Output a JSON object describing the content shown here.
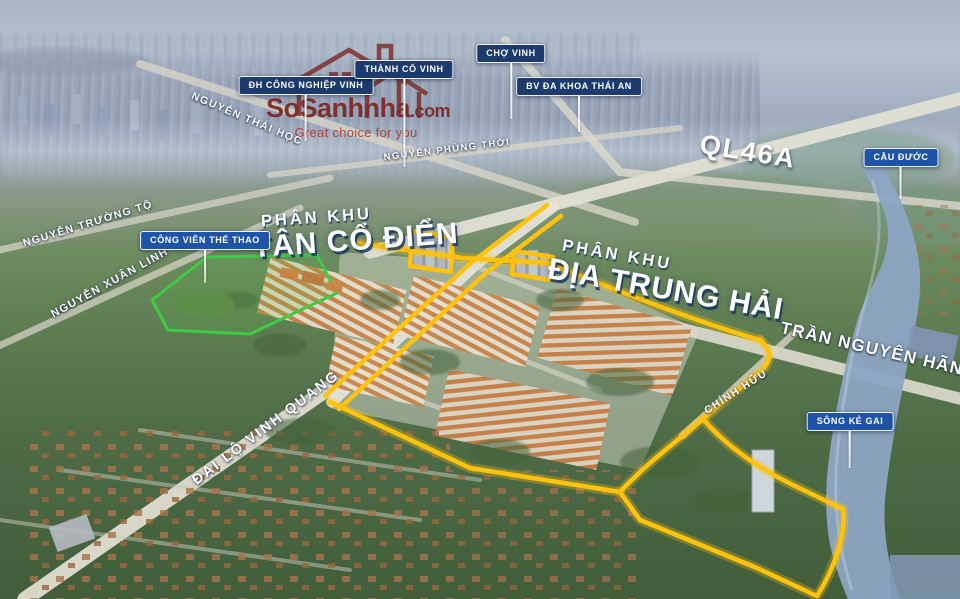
{
  "watermark": {
    "brand": "SoSanhnha",
    "tld": ".com",
    "tagline": "Great choice for you"
  },
  "pois": [
    {
      "id": "dh-cong-nghiep-vinh",
      "label": "ĐH CÔNG NGHIỆP VINH"
    },
    {
      "id": "thanh-co-vinh",
      "label": "THÀNH CỔ VINH"
    },
    {
      "id": "cho-vinh",
      "label": "CHỢ VINH"
    },
    {
      "id": "bv-da-khoa-thai-an",
      "label": "BV ĐA KHOA THÁI AN"
    },
    {
      "id": "cau-duoc",
      "label": "CẦU ĐƯỚC"
    },
    {
      "id": "cong-vien-the-thao",
      "label": "CÔNG VIÊN THỂ THAO"
    },
    {
      "id": "song-ke-gai",
      "label": "SÔNG KẺ GAI"
    }
  ],
  "roads": [
    {
      "id": "nguyen-thai-hoc",
      "name": "NGUYỄN THÁI HỌC"
    },
    {
      "id": "nguyen-phung-thoi",
      "name": "NGUYỄN PHÙNG THỜI"
    },
    {
      "id": "nguyen-truong-to",
      "name": "NGUYỄN TRƯỜNG TỘ"
    },
    {
      "id": "nguyen-xuan-linh",
      "name": "NGUYỄN XUÂN LINH"
    },
    {
      "id": "ql46a",
      "name": "QL46A"
    },
    {
      "id": "dai-lo-vinh-quang",
      "name": "ĐẠI LỘ VINH QUANG"
    },
    {
      "id": "tran-nguyen-han",
      "name": "TRẦN NGUYÊN HÃN"
    },
    {
      "id": "chinh-huu",
      "name": "CHÍNH HỮU"
    }
  ],
  "zones": [
    {
      "kicker": "PHÂN KHU",
      "title": "TÂN CỔ ĐIỂN"
    },
    {
      "kicker": "PHÂN KHU",
      "title": "ĐỊA TRUNG HẢI"
    }
  ],
  "colors": {
    "boundary_yellow": "#FFC20E",
    "park_outline_green": "#3ECB46",
    "badge_navy": "#1C3A6B",
    "badge_blue": "#1E54A8",
    "watermark_maroon": "#7A2824",
    "river_blue": "#8DA5C3"
  }
}
